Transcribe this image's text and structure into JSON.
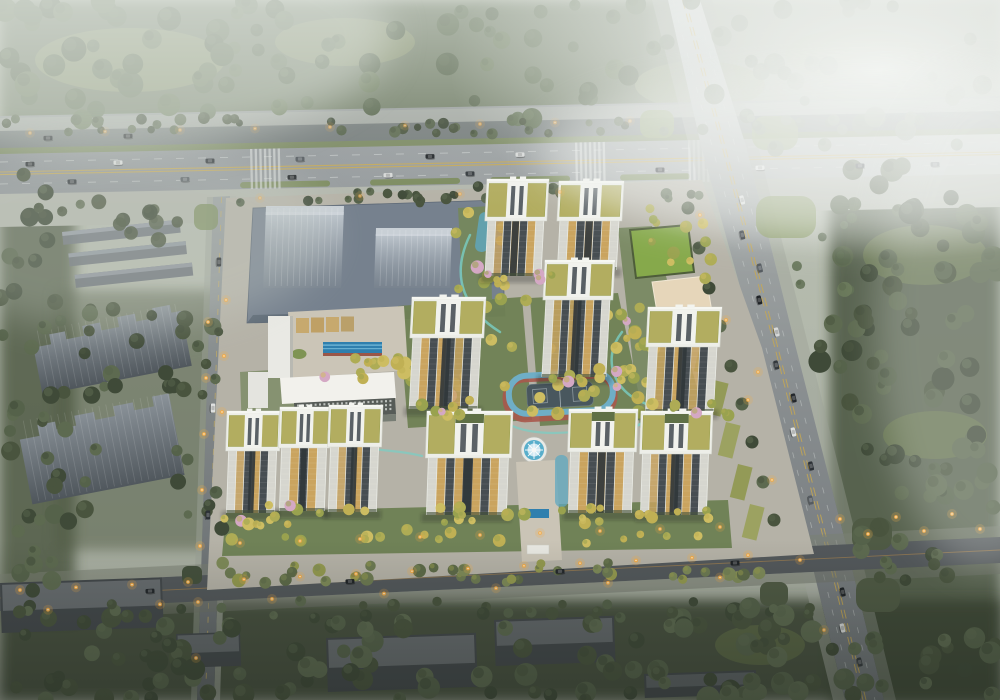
{
  "scene": {
    "description": "Dusk aerial rendering of a residential tower complex with landscaped courtyards, bounded by a tree-lined highway (top), a diagonal avenue (right), a west street and a lamp-lit road (bottom); hazy fog over the upper right",
    "residential_towers": 11,
    "future_plot_buildings": 2,
    "context_ghost_slabs": 2,
    "context_lowrise_rows": 3,
    "warehouses": 5,
    "water_features": [
      "rooftop-lap-pool",
      "central-fountain",
      "entry-pool",
      "garden-stream"
    ],
    "sports_features": [
      "running-track",
      "ball-court",
      "lawn-court"
    ]
  },
  "palette": {
    "bg_top": "#bcc2b5",
    "bg_mid": "#b2b8ab",
    "bg_bottom": "#a3a99c",
    "fog": "#eef1ee",
    "forest_dark": "#49543e",
    "forest_mid": "#5f6e52",
    "forest_light": "#7d8a74",
    "grass_clearing": "#8b9770",
    "road_light": "#9ba09f",
    "road_dark": "#53585b",
    "road_service": "#6f7576",
    "lane_yellow": "#c9a94f",
    "lane_white": "#d8dcda",
    "sidewalk": "#b3b7ad",
    "median_green": "#7c8b5f",
    "corner_lawn": "#8a9a66",
    "site_pavement": "#b5b2a7",
    "plot_blue": "#76818e",
    "plot_prism": "#a4aeb8",
    "school_white": "#f2f1ec",
    "school_deck": "#cbc5b7",
    "court_tan": "#c7a96e",
    "pool_water": "#2f7fae",
    "pool_edge": "#9a5648",
    "lawn_court": "#86a94b",
    "garden_green": "#6f8153",
    "clubhouse_tan": "#e6d6ba",
    "track_blue": "#6faec6",
    "track_red": "#a8584c",
    "court_dark": "#49575e",
    "path_teal": "#79cec4",
    "fountain_ring": "#e9eae6",
    "fountain_water": "#58aecb",
    "crown_white": "#edeee8",
    "roof_garden": "#b2ad60",
    "roof_garden_dark": "#5f7046",
    "facade_lit": "#caa45f",
    "facade_dark": "#474e52",
    "facade_end": "#d6d6cf",
    "ghost_gray": "#5a6169",
    "ghost_light": "#7c848c",
    "warehouse_top": "#676c6f",
    "warehouse_side": "#43484b",
    "tree_yellow": "#c0b054",
    "tree_olive": "#8f9b4f",
    "tree_pink": "#d4a8c4",
    "streetlight": "#f5ab44",
    "car_dark": "#23272b",
    "car_white": "#dfe1e0"
  }
}
